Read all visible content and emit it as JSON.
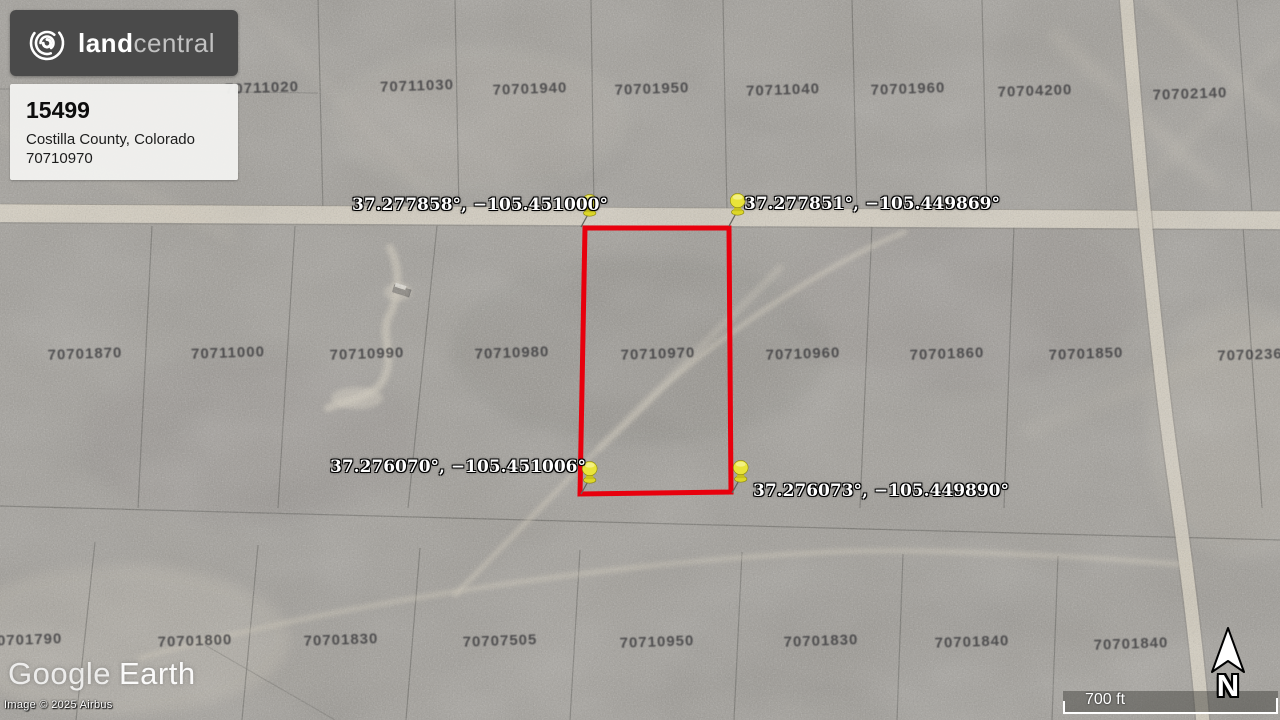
{
  "listing_card": {
    "brand": {
      "land": "land",
      "central": "central"
    },
    "listing_id": "15499",
    "county": "Costilla County, Colorado",
    "apn": "70710970"
  },
  "pins": [
    {
      "corner": "top-left",
      "label": "37.277858°, −105.451000°"
    },
    {
      "corner": "top-right",
      "label": "37.277851°, −105.449869°"
    },
    {
      "corner": "bottom-left",
      "label": "37.276070°, −105.451006°"
    },
    {
      "corner": "bottom-right",
      "label": "37.276073°, −105.449890°"
    }
  ],
  "map": {
    "parcel_labels": [
      {
        "text": "70711020"
      },
      {
        "text": "70711030"
      },
      {
        "text": "70701940"
      },
      {
        "text": "70701950"
      },
      {
        "text": "70711040"
      },
      {
        "text": "70701960"
      },
      {
        "text": "70704200"
      },
      {
        "text": "70702140"
      },
      {
        "text": "70701870"
      },
      {
        "text": "70711000"
      },
      {
        "text": "70710990"
      },
      {
        "text": "70710980"
      },
      {
        "text": "70710970"
      },
      {
        "text": "70710960"
      },
      {
        "text": "70701860"
      },
      {
        "text": "70701850"
      },
      {
        "text": "7070236"
      },
      {
        "text": "70701790"
      },
      {
        "text": "70701800"
      },
      {
        "text": "70701830"
      },
      {
        "text": "70707505"
      },
      {
        "text": "70710950"
      },
      {
        "text": "70701830"
      },
      {
        "text": "70701840"
      },
      {
        "text": "70701840"
      }
    ]
  },
  "attribution": {
    "google": "Google",
    "earth": "Earth",
    "copyright": "Image © 2025 Airbus"
  },
  "scale_bar": {
    "label": "700 ft"
  },
  "compass": {
    "label": "N"
  },
  "colors": {
    "selection_outline": "#e8000d",
    "pin_yellow": "#e9e43a",
    "road": "#dad3c3"
  }
}
